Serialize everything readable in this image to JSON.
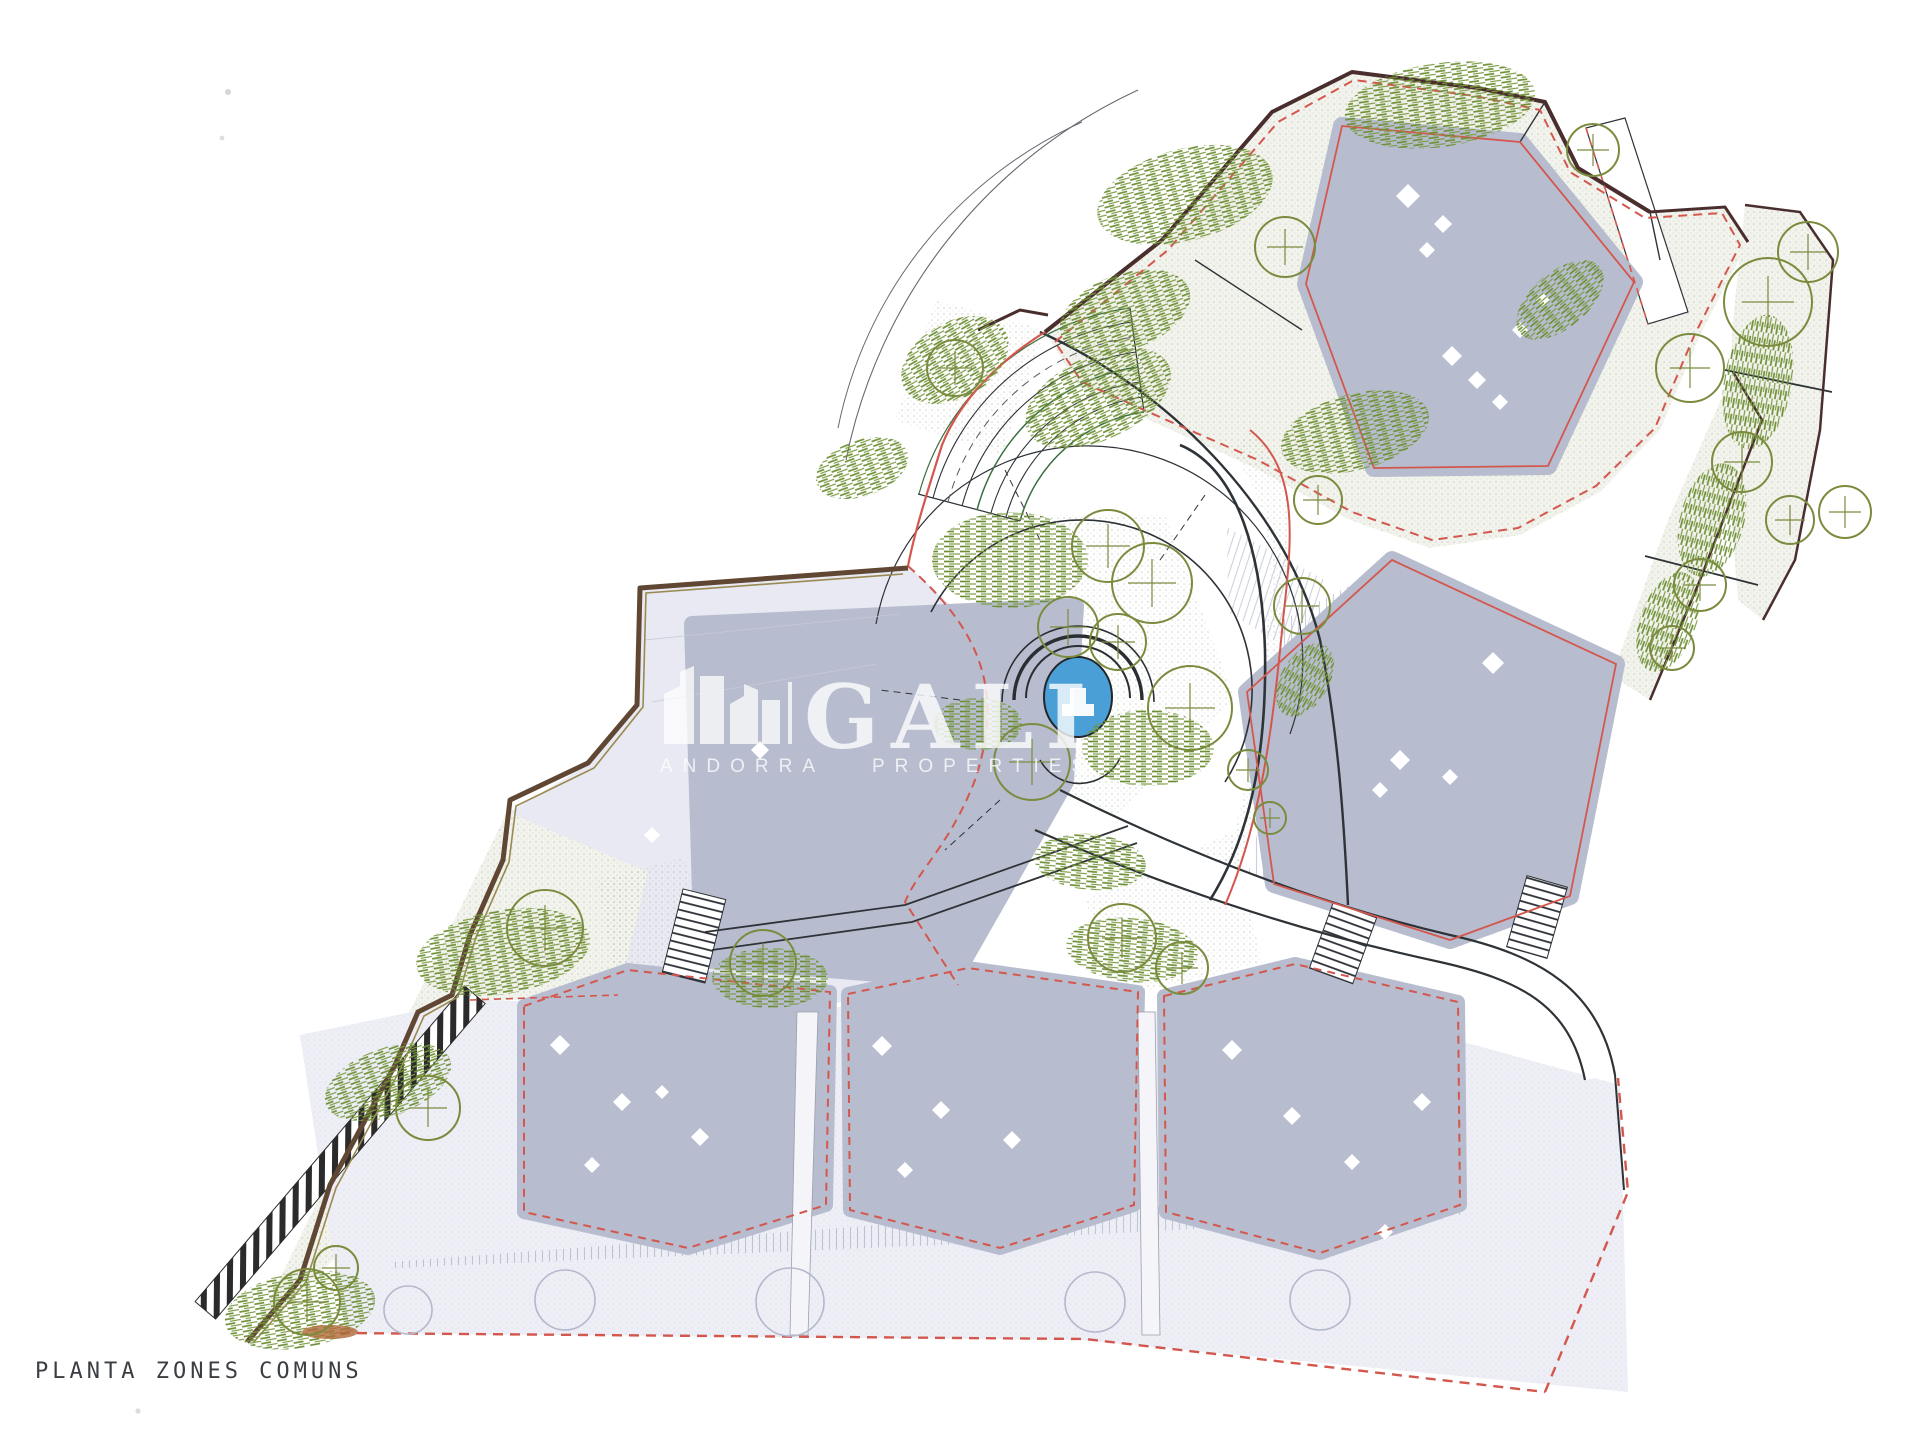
{
  "page": {
    "background": "#ffffff"
  },
  "drawing_title": {
    "label": "PLANTA ZONES COMUNS"
  },
  "watermark": {
    "brand": "GALI",
    "word_left": "ANDORRA",
    "word_right": "PROPERTIES"
  },
  "palette": {
    "roof_gray": "#b7bdce",
    "parcel_lavender": "#e8e9f2",
    "terrace_lavender": "#edeef6",
    "ground_pale_green": "#f2f3ec",
    "ground_dot_green": "#97a289",
    "tree_olive": "#7b8b3e",
    "shrub_green": "#6d8f35",
    "boundary_brown": "#5f4733",
    "boundary_red": "#d4574e",
    "line_dark": "#2e3338",
    "pool_blue": "#4aa0d6"
  }
}
